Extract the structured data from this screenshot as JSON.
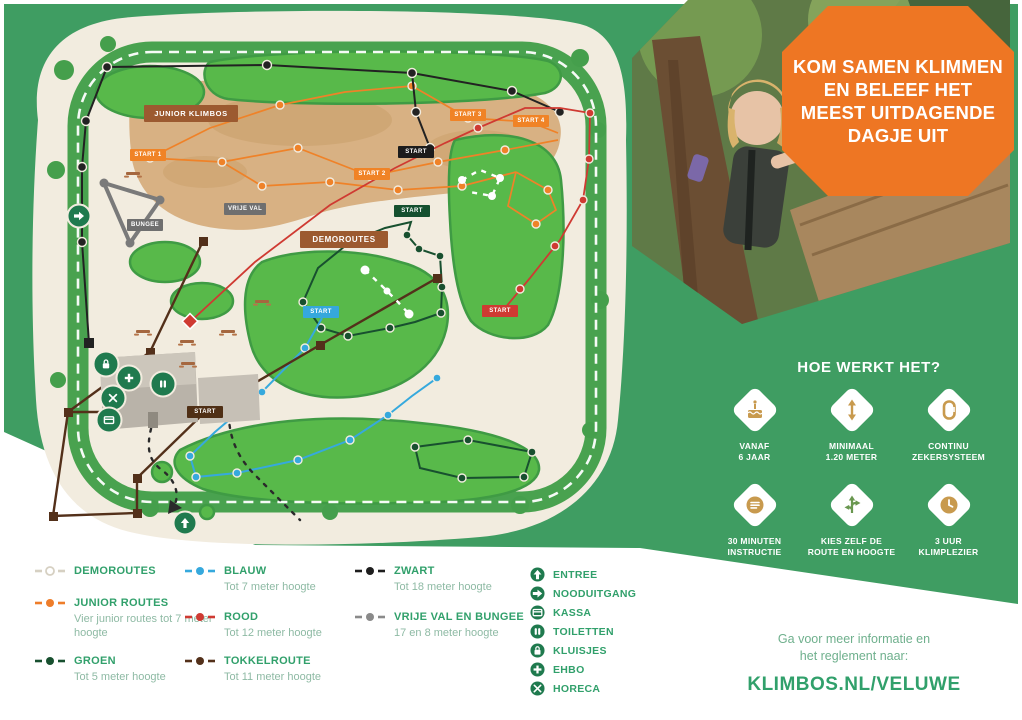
{
  "colors": {
    "background_green": "#3f9d62",
    "map_cream": "#f2ecdf",
    "island_green": "#58b94a",
    "badge_orange": "#ee7623",
    "label_brown": "#9c5a30",
    "legend_green_text": "#31a06b",
    "facility_green": "#1f7a4e",
    "route_junior": "#ef8228",
    "route_zwart": "#1e1e1e",
    "route_groen": "#18502f",
    "route_blauw": "#36a9dd",
    "route_rood": "#cf3a32",
    "route_tokkel": "#53301a",
    "route_vrije_val": "#8a8a8a"
  },
  "badge": {
    "lines": [
      "KOM SAMEN KLIMMEN",
      "EN BELEEF HET",
      "MEEST UITDAGENDE",
      "DAGJE UIT"
    ]
  },
  "how_it_works": {
    "title": "HOE WERKT HET?",
    "items": [
      {
        "icon": "cake-icon",
        "line1": "VANAF",
        "line2": "6 JAAR"
      },
      {
        "icon": "min-height-icon",
        "line1": "MINIMAAL",
        "line2": "1.20 METER"
      },
      {
        "icon": "carabiner-icon",
        "line1": "CONTINU",
        "line2": "ZEKERSYSTEEM"
      },
      {
        "icon": "instruction-icon",
        "line1": "30 MINUTEN",
        "line2": "INSTRUCTIE"
      },
      {
        "icon": "route-choice-icon",
        "line1": "KIES ZELF DE",
        "line2": "ROUTE EN HOOGTE"
      },
      {
        "icon": "clock-icon",
        "line1": "3 UUR",
        "line2": "KLIMPLEZIER"
      }
    ]
  },
  "info": {
    "line1": "Ga voor meer informatie en",
    "line2": "het reglement naar:",
    "url": "KLIMBOS.NL/VELUWE"
  },
  "map": {
    "area_labels": {
      "junior_klimbos": "JUNIOR KLIMBOS",
      "demoroutes": "DEMOROUTES",
      "bungee": "BUNGEE",
      "vrije_val": "VRIJE VAL"
    },
    "start_labels": {
      "junior1": "START 1",
      "junior2": "START 2",
      "junior3": "START 3",
      "junior4": "START 4",
      "zwart": "START",
      "groen": "START",
      "blauw": "START",
      "rood": "START",
      "tokkel": "START"
    }
  },
  "legend": {
    "routes": [
      {
        "name": "DEMOROUTES",
        "desc": "",
        "color": "#ffffff"
      },
      {
        "name": "JUNIOR ROUTES",
        "desc": "Vier junior routes tot 7 meter hoogte",
        "color": "#ee7d2a"
      },
      {
        "name": "GROEN",
        "desc": "Tot 5 meter hoogte",
        "color": "#18502f"
      },
      {
        "name": "BLAUW",
        "desc": "Tot 7 meter hoogte",
        "color": "#36a9dd"
      },
      {
        "name": "ROOD",
        "desc": "Tot 12 meter hoogte",
        "color": "#cf3a32"
      },
      {
        "name": "TOKKELROUTE",
        "desc": "Tot 11 meter hoogte",
        "color": "#53301a"
      },
      {
        "name": "ZWART",
        "desc": "Tot 18 meter hoogte",
        "color": "#1e1e1e"
      },
      {
        "name": "VRIJE VAL EN BUNGEE",
        "desc": "17 en 8 meter hoogte",
        "color": "#8a8a8a"
      }
    ],
    "facilities": [
      {
        "icon": "entree-icon",
        "label": "ENTREE"
      },
      {
        "icon": "nooduitgang-icon",
        "label": "NOODUITGANG"
      },
      {
        "icon": "kassa-icon",
        "label": "KASSA"
      },
      {
        "icon": "toiletten-icon",
        "label": "TOILETTEN"
      },
      {
        "icon": "kluisjes-icon",
        "label": "KLUISJES"
      },
      {
        "icon": "ehbo-icon",
        "label": "EHBO"
      },
      {
        "icon": "horeca-icon",
        "label": "HORECA"
      }
    ]
  }
}
